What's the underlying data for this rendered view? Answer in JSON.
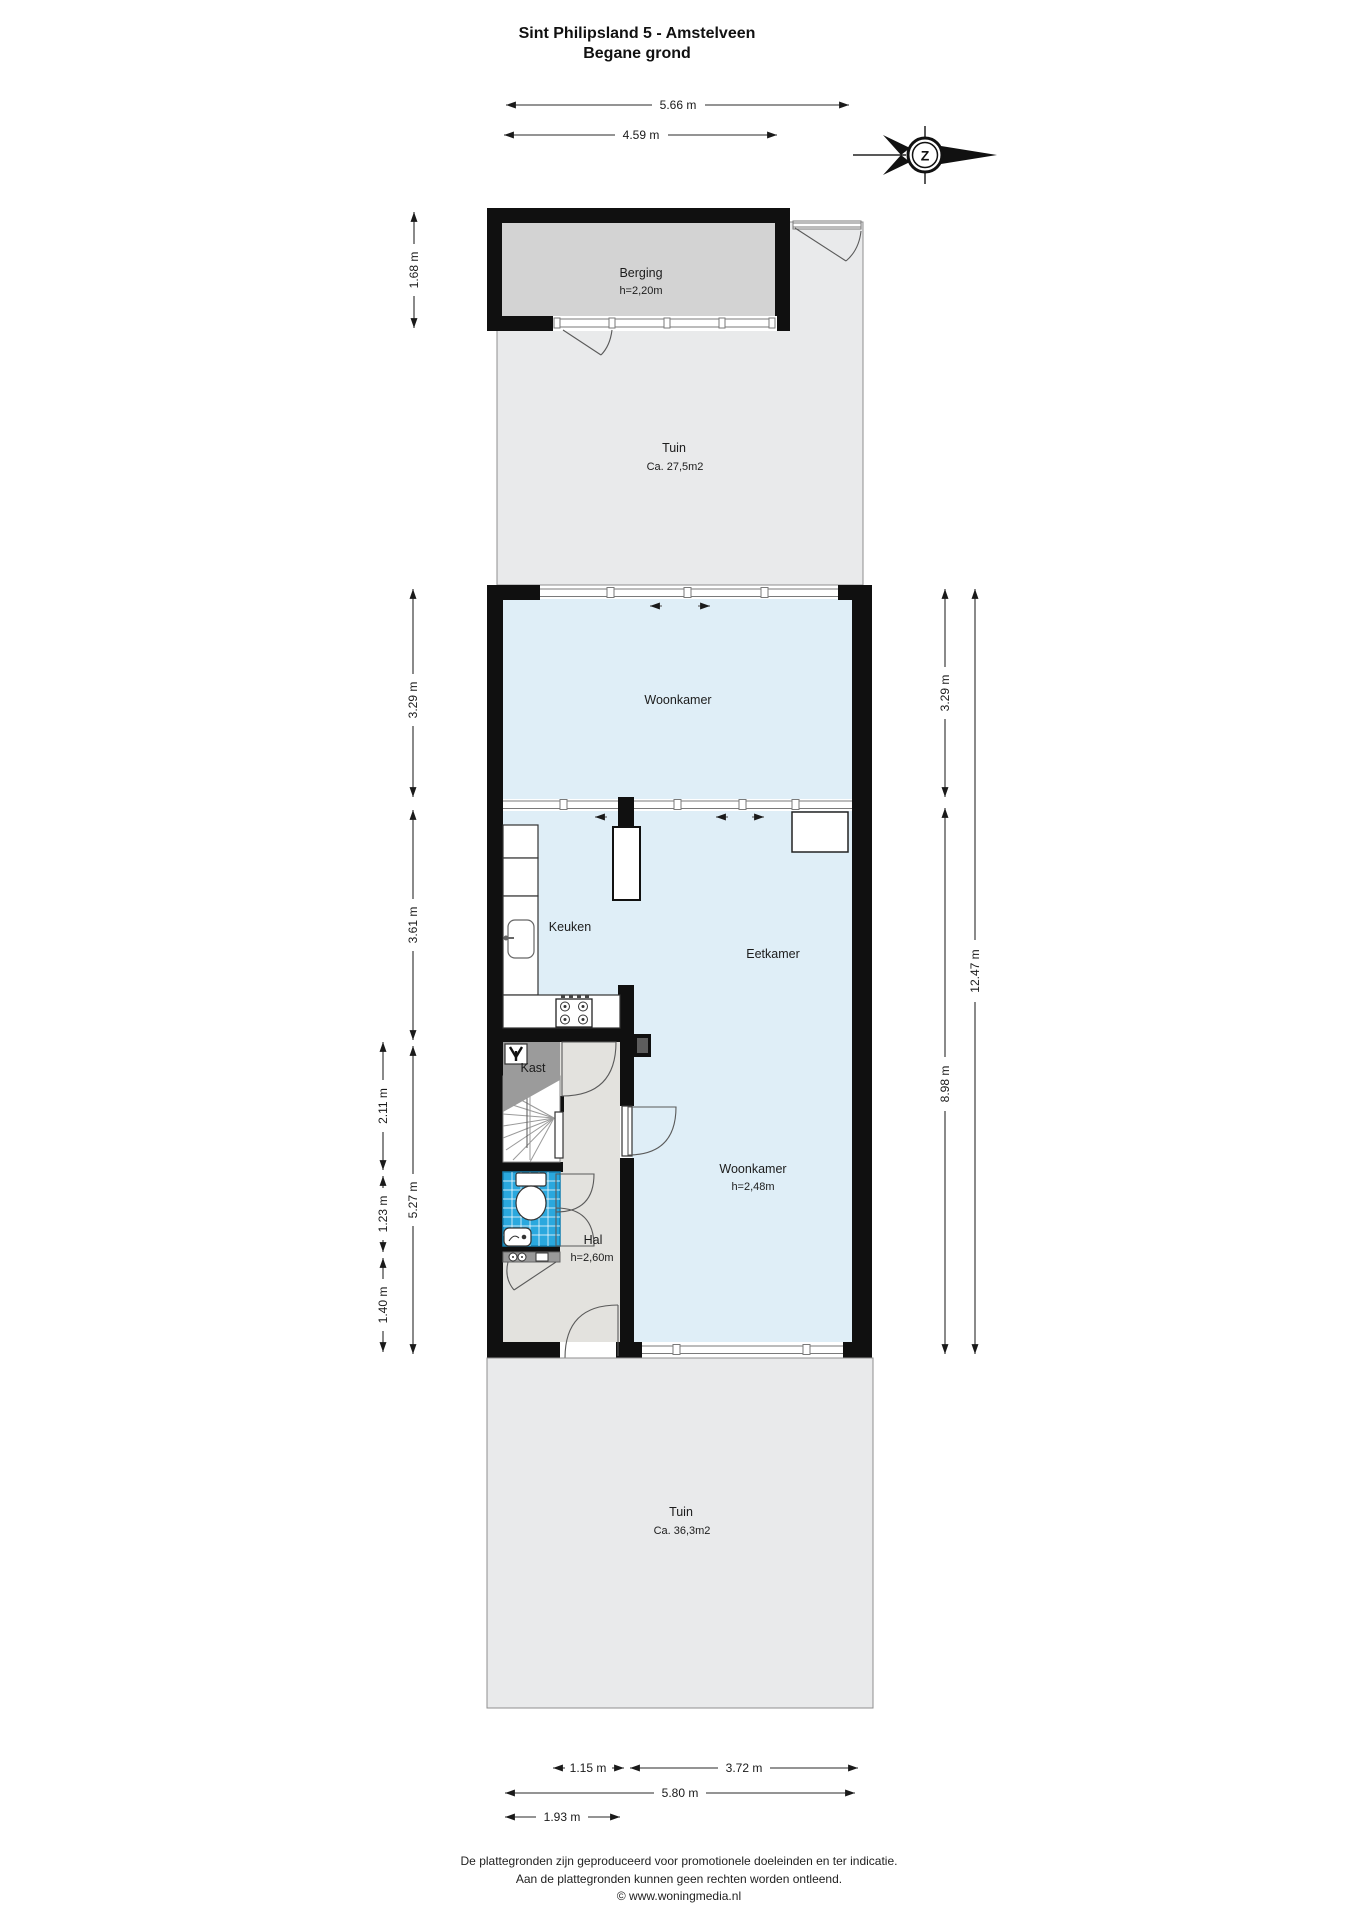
{
  "title": {
    "line1": "Sint Philipsland 5 - Amstelveen",
    "line2": "Begane grond"
  },
  "compass": {
    "label": "Z"
  },
  "rooms": {
    "berging": {
      "name": "Berging",
      "ceiling": "h=2,20m"
    },
    "tuin_north": {
      "name": "Tuin",
      "area": "Ca. 27,5m2"
    },
    "woonkamer_north": {
      "name": "Woonkamer"
    },
    "keuken": {
      "name": "Keuken"
    },
    "eetkamer": {
      "name": "Eetkamer"
    },
    "woonkamer": {
      "name": "Woonkamer",
      "ceiling": "h=2,48m"
    },
    "kast": {
      "name": "Kast"
    },
    "hal": {
      "name": "Hal",
      "ceiling": "h=2,60m"
    },
    "tuin_south": {
      "name": "Tuin",
      "area": "Ca. 36,3m2"
    }
  },
  "dimensions": {
    "top_width_total": "5.66 m",
    "top_width_berging": "4.59 m",
    "berging_depth": "1.68 m",
    "left_woonkamer": "3.29 m",
    "left_keuken": "3.61 m",
    "left_hal": "5.27 m",
    "left_kast_trap": "2.11 m",
    "left_toilet": "1.23 m",
    "left_entree": "1.40 m",
    "right_woonkamer": "3.29 m",
    "right_south": "8.98 m",
    "right_total": "12.47 m",
    "bottom_door": "1.15 m",
    "bottom_woonkamer": "3.72 m",
    "bottom_total": "5.80 m",
    "bottom_hal": "1.93 m"
  },
  "footer": {
    "line1": "De plattegronden zijn geproduceerd voor promotionele doeleinden en ter indicatie.",
    "line2": "Aan de plattegronden kunnen geen rechten worden ontleend.",
    "line3": "© www.woningmedia.nl"
  },
  "colors": {
    "room_blue": "#dfeef7",
    "hall_grey": "#e3e2de",
    "garden_grey": "#e9eaeb",
    "berging_grey": "#d3d3d3",
    "closet_grey": "#9b9b9b",
    "tile_blue": "#2aa8de",
    "wall_black": "#101010"
  }
}
